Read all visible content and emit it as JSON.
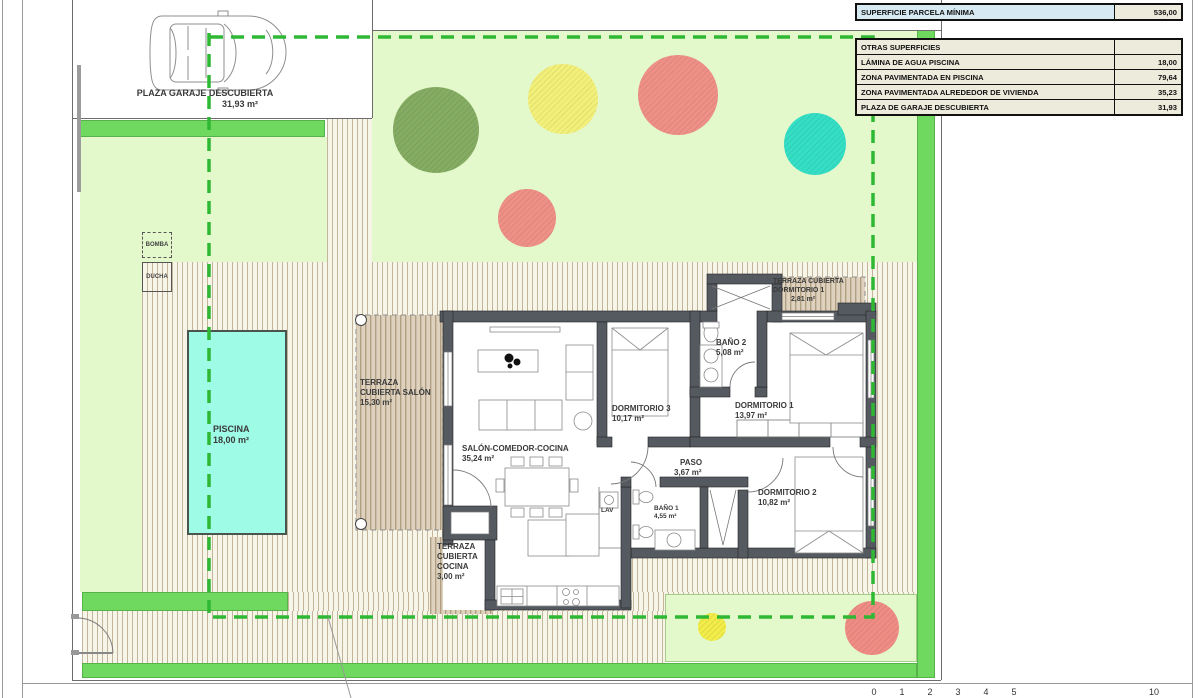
{
  "legend_table": {
    "header": {
      "label": "SUPERFICIE PARCELA MÍNIMA",
      "value": "536,00"
    },
    "subheader": {
      "label": "OTRAS SUPERFICIES",
      "value": ""
    },
    "rows": [
      {
        "label": "LÁMINA DE AGUA PISCINA",
        "value": "18,00"
      },
      {
        "label": "ZONA PAVIMENTADA EN PISCINA",
        "value": "79,64"
      },
      {
        "label": "ZONA PAVIMENTADA ALREDEDOR DE VIVIENDA",
        "value": "35,23"
      },
      {
        "label": "PLAZA DE GARAJE DESCUBIERTA",
        "value": "31,93"
      }
    ]
  },
  "site": {
    "garage": {
      "label": "PLAZA GARAJE DESCUBIERTA",
      "area": "31,93 m²"
    },
    "pool": {
      "label": "PISCINA",
      "area": "18,00 m²"
    },
    "bomba": "BOMBA",
    "ducha": "DUCHA"
  },
  "rooms": {
    "terraza_salon": {
      "line1": "TERRAZA",
      "line2": "CUBIERTA SALÓN",
      "area": "15,30 m²"
    },
    "salon": {
      "label": "SALÓN-COMEDOR-COCINA",
      "area": "35,24 m²"
    },
    "dorm3": {
      "label": "DORMITORIO 3",
      "area": "10,17 m²"
    },
    "dorm1": {
      "label": "DORMITORIO 1",
      "area": "13,97 m²"
    },
    "dorm2": {
      "label": "DORMITORIO 2",
      "area": "10,82 m²"
    },
    "bano2": {
      "label": "BAÑO 2",
      "area": "5,08 m²"
    },
    "bano1": {
      "label": "BAÑO 1",
      "area": "4,55 m²"
    },
    "paso": {
      "label": "PASO",
      "area": "3,67 m²"
    },
    "lav": "LAV",
    "terraza_cocina": {
      "line1": "TERRAZA",
      "line2": "CUBIERTA",
      "line3": "COCINA",
      "area": "3,00 m²"
    },
    "terraza_dorm1": {
      "line1": "TERRAZA CUBIERTA",
      "line2": "DORMITORIO 1",
      "area": "2,81 m²"
    }
  },
  "scale_ruler": {
    "labels": [
      "0",
      "1",
      "2",
      "3",
      "4",
      "5",
      "10"
    ]
  },
  "colors": {
    "lawn_light": "#e3f8cb",
    "grass_border": "#6fd95f",
    "parcel_dashed_line": "#2eb833",
    "pool_water": "#9efbe5",
    "wall": "#555a60",
    "paving_line": "#c3b59c",
    "tree_green": "#85ac63",
    "tree_yellow": "#f3f07a",
    "tree_salmon": "#ef9086",
    "tree_teal": "#35dfc6",
    "legend_header_bg": "#d7eaf4",
    "legend_row_bg": "#edebdc"
  }
}
